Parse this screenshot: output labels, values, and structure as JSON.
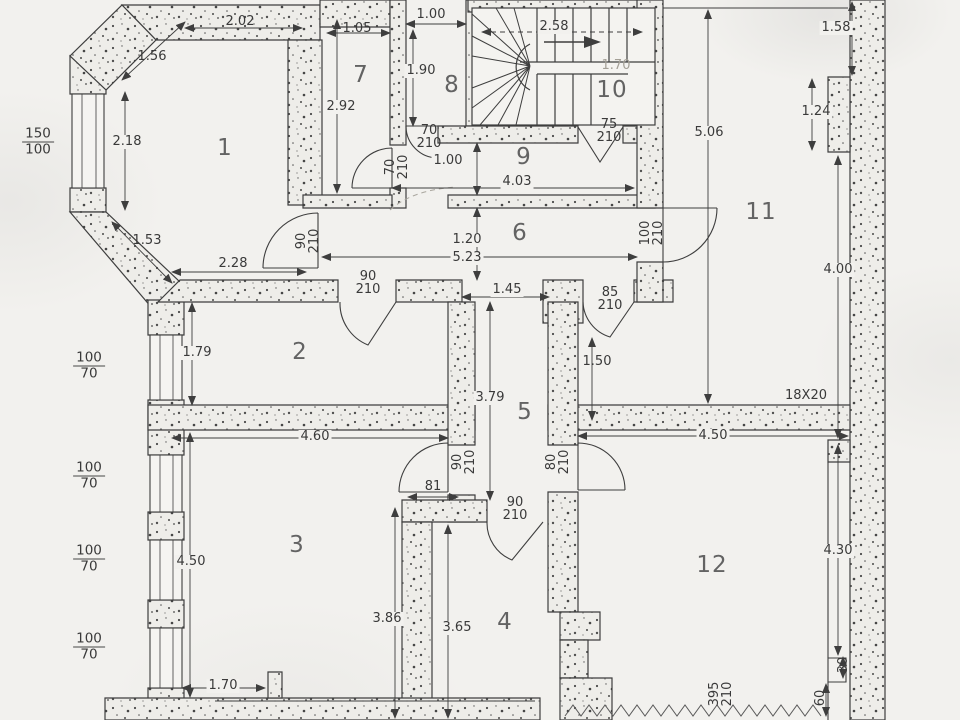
{
  "drawing": {
    "kind": "scanned architectural floor plan",
    "colors": {
      "paper": "#f2f1ee",
      "ink": "#3e3e3e",
      "pencil": "#a4a097"
    },
    "rooms": [
      {
        "number": "1",
        "x": 225,
        "y": 148
      },
      {
        "number": "2",
        "x": 300,
        "y": 352
      },
      {
        "number": "3",
        "x": 297,
        "y": 545
      },
      {
        "number": "4",
        "x": 505,
        "y": 622
      },
      {
        "number": "5",
        "x": 525,
        "y": 412
      },
      {
        "number": "6",
        "x": 520,
        "y": 233
      },
      {
        "number": "7",
        "x": 361,
        "y": 75
      },
      {
        "number": "8",
        "x": 452,
        "y": 85
      },
      {
        "number": "9",
        "x": 524,
        "y": 157
      },
      {
        "number": "10",
        "x": 612,
        "y": 90
      },
      {
        "number": "11",
        "x": 761,
        "y": 212
      },
      {
        "number": "12",
        "x": 712,
        "y": 565
      }
    ],
    "dimensions": [
      {
        "text": "2.02",
        "x": 240,
        "y": 22
      },
      {
        "text": "1.56",
        "x": 152,
        "y": 57
      },
      {
        "text": "2.18",
        "x": 127,
        "y": 142,
        "boxed": true
      },
      {
        "text": "1.53",
        "x": 147,
        "y": 241
      },
      {
        "text": "2.28",
        "x": 233,
        "y": 264
      },
      {
        "text": "1.05",
        "x": 357,
        "y": 29
      },
      {
        "text": "2.92",
        "x": 341,
        "y": 107,
        "boxed": true
      },
      {
        "text": "1.00",
        "x": 431,
        "y": 15
      },
      {
        "text": "1.90",
        "x": 421,
        "y": 71,
        "boxed": true
      },
      {
        "text": "2.58",
        "x": 554,
        "y": 27,
        "boxed": true
      },
      {
        "text": "1.70",
        "x": 616,
        "y": 66,
        "faint": true
      },
      {
        "text": "1.00",
        "x": 448,
        "y": 161,
        "boxed": true
      },
      {
        "text": "4.03",
        "x": 517,
        "y": 182,
        "boxed": true
      },
      {
        "text": "5.06",
        "x": 709,
        "y": 133,
        "boxed": true
      },
      {
        "text": "1.58",
        "x": 836,
        "y": 28,
        "boxed": true
      },
      {
        "text": "1.24",
        "x": 816,
        "y": 112,
        "boxed": true
      },
      {
        "text": "4.00",
        "x": 838,
        "y": 270,
        "boxed": true
      },
      {
        "text": "1.20",
        "x": 467,
        "y": 240,
        "boxed": true
      },
      {
        "text": "5.23",
        "x": 467,
        "y": 258,
        "boxed": true
      },
      {
        "text": "1.45",
        "x": 507,
        "y": 290,
        "boxed": true
      },
      {
        "text": "1.79",
        "x": 197,
        "y": 353,
        "boxed": true
      },
      {
        "text": "1.50",
        "x": 597,
        "y": 362
      },
      {
        "text": "3.79",
        "x": 490,
        "y": 398,
        "boxed": true
      },
      {
        "text": "18X20",
        "x": 806,
        "y": 396
      },
      {
        "text": "4.60",
        "x": 315,
        "y": 437,
        "boxed": true
      },
      {
        "text": "4.50",
        "x": 713,
        "y": 436,
        "boxed": true
      },
      {
        "text": "4.50",
        "x": 191,
        "y": 562,
        "boxed": true
      },
      {
        "text": "4.30",
        "x": 838,
        "y": 551,
        "boxed": true
      },
      {
        "text": "3.86",
        "x": 387,
        "y": 619,
        "boxed": true
      },
      {
        "text": "3.65",
        "x": 457,
        "y": 628,
        "boxed": true
      },
      {
        "text": "81",
        "x": 433,
        "y": 487
      },
      {
        "text": "1.70",
        "x": 223,
        "y": 686,
        "boxed": true
      },
      {
        "text": "30",
        "x": 844,
        "y": 665,
        "rot": -90
      },
      {
        "text": "60",
        "x": 821,
        "y": 698,
        "rot": -90
      }
    ],
    "opening_sizes": [
      {
        "top": "70",
        "bottom": "210",
        "x": 429,
        "y": 137
      },
      {
        "top": "70",
        "bottom": "210",
        "x": 397,
        "y": 167,
        "rot": -90
      },
      {
        "top": "75",
        "bottom": "210",
        "x": 609,
        "y": 131
      },
      {
        "top": "90",
        "bottom": "210",
        "x": 308,
        "y": 241,
        "rot": -90
      },
      {
        "top": "90",
        "bottom": "210",
        "x": 368,
        "y": 283
      },
      {
        "top": "85",
        "bottom": "210",
        "x": 610,
        "y": 299
      },
      {
        "top": "100",
        "bottom": "210",
        "x": 652,
        "y": 233,
        "rot": -90
      },
      {
        "top": "90",
        "bottom": "210",
        "x": 464,
        "y": 462,
        "rot": -90
      },
      {
        "top": "80",
        "bottom": "210",
        "x": 558,
        "y": 462,
        "rot": -90
      },
      {
        "top": "90",
        "bottom": "210",
        "x": 515,
        "y": 509
      },
      {
        "top": "395",
        "bottom": "210",
        "x": 721,
        "y": 694,
        "rot": -90
      }
    ],
    "window_sizes": [
      {
        "top": "150",
        "bottom": "100",
        "x": 38,
        "y": 142
      },
      {
        "top": "100",
        "bottom": "70",
        "x": 89,
        "y": 366
      },
      {
        "top": "100",
        "bottom": "70",
        "x": 89,
        "y": 476
      },
      {
        "top": "100",
        "bottom": "70",
        "x": 89,
        "y": 559
      },
      {
        "top": "100",
        "bottom": "70",
        "x": 89,
        "y": 647
      }
    ]
  }
}
